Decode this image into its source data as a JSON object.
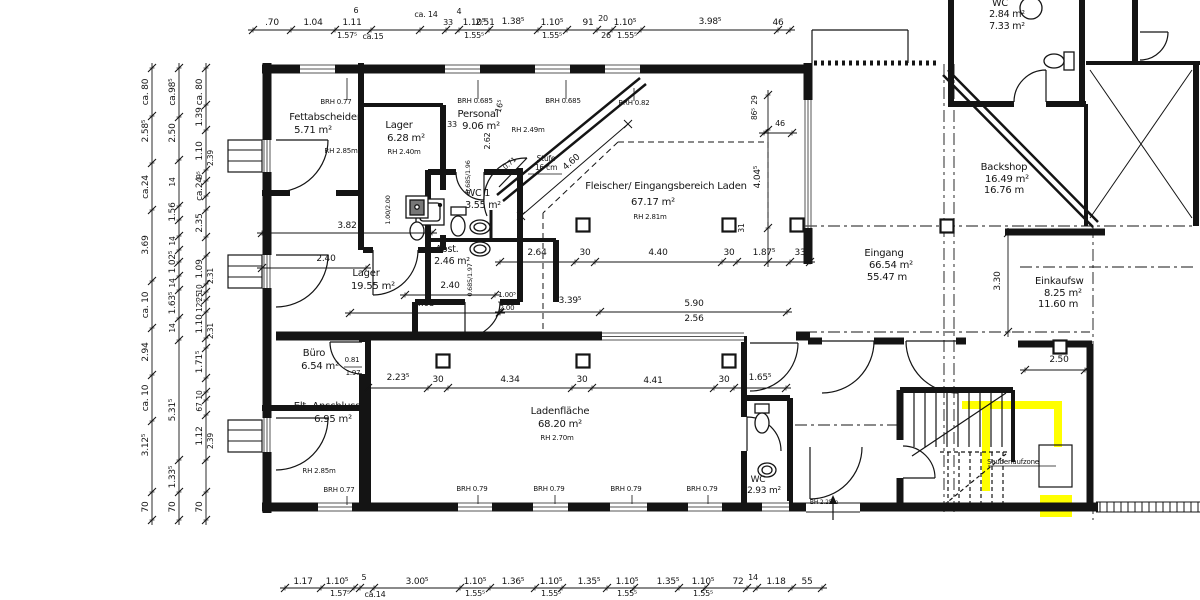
{
  "meta": {
    "drawing_type": "architectural floor plan",
    "highlight_color": "#ffff00",
    "line_color": "#141414",
    "background": "#ffffff"
  },
  "labels": [
    {
      "t": ".70",
      "x": 272,
      "y": 25
    },
    {
      "t": "1.04",
      "x": 313,
      "y": 25
    },
    {
      "t": "6",
      "x": 356,
      "y": 13,
      "s": 8
    },
    {
      "t": "1.11",
      "x": 352,
      "y": 25
    },
    {
      "t": "1.57⁵",
      "x": 347,
      "y": 38,
      "s": 8
    },
    {
      "t": "ca.15",
      "x": 373,
      "y": 39,
      "s": 8
    },
    {
      "t": "ca. 14",
      "x": 426,
      "y": 17,
      "s": 8
    },
    {
      "t": "2.51",
      "x": 485,
      "y": 25
    },
    {
      "t": "33",
      "x": 448,
      "y": 25,
      "s": 8
    },
    {
      "t": "4",
      "x": 459,
      "y": 14,
      "s": 8
    },
    {
      "t": "1.10⁵",
      "x": 474,
      "y": 25
    },
    {
      "t": "1.55⁵",
      "x": 474,
      "y": 38,
      "s": 8
    },
    {
      "t": "1.38⁵",
      "x": 513,
      "y": 24
    },
    {
      "t": "1.10⁵",
      "x": 552,
      "y": 25
    },
    {
      "t": "1.55⁵",
      "x": 552,
      "y": 38,
      "s": 8
    },
    {
      "t": "91",
      "x": 588,
      "y": 25
    },
    {
      "t": "20",
      "x": 603,
      "y": 21,
      "s": 8
    },
    {
      "t": "26",
      "x": 606,
      "y": 38,
      "s": 8
    },
    {
      "t": "1.10⁵",
      "x": 625,
      "y": 25
    },
    {
      "t": "1.55⁵",
      "x": 627,
      "y": 38,
      "s": 8
    },
    {
      "t": "3.98⁵",
      "x": 710,
      "y": 24
    },
    {
      "t": "46",
      "x": 778,
      "y": 25
    },
    {
      "t": "1.17",
      "x": 303,
      "y": 584
    },
    {
      "t": "1.10⁵",
      "x": 337,
      "y": 584
    },
    {
      "t": "1.57⁵",
      "x": 340,
      "y": 596,
      "s": 8
    },
    {
      "t": "5",
      "x": 364,
      "y": 580,
      "s": 8
    },
    {
      "t": "ca.14",
      "x": 375,
      "y": 597,
      "s": 8
    },
    {
      "t": "3.00⁵",
      "x": 417,
      "y": 584
    },
    {
      "t": "1.10⁵",
      "x": 475,
      "y": 584
    },
    {
      "t": "1.55⁵",
      "x": 475,
      "y": 596,
      "s": 8
    },
    {
      "t": "1.36⁵",
      "x": 513,
      "y": 584
    },
    {
      "t": "1.10⁵",
      "x": 551,
      "y": 584
    },
    {
      "t": "1.55⁵",
      "x": 551,
      "y": 596,
      "s": 8
    },
    {
      "t": "1.35⁵",
      "x": 589,
      "y": 584
    },
    {
      "t": "1.10⁵",
      "x": 627,
      "y": 584
    },
    {
      "t": "1.55⁵",
      "x": 627,
      "y": 596,
      "s": 8
    },
    {
      "t": "1.35⁵",
      "x": 668,
      "y": 584
    },
    {
      "t": "1.10⁵",
      "x": 703,
      "y": 584
    },
    {
      "t": "1.55⁵",
      "x": 703,
      "y": 596,
      "s": 8
    },
    {
      "t": "72",
      "x": 738,
      "y": 584
    },
    {
      "t": "14",
      "x": 753,
      "y": 580,
      "s": 8
    },
    {
      "t": "1.18",
      "x": 776,
      "y": 584
    },
    {
      "t": "55",
      "x": 807,
      "y": 584
    },
    {
      "t": "ca. 80",
      "x": 148,
      "y": 92,
      "r": -90
    },
    {
      "t": "2.58⁵",
      "x": 148,
      "y": 131,
      "r": -90
    },
    {
      "t": "ca.24",
      "x": 148,
      "y": 187,
      "r": -90
    },
    {
      "t": "3.69",
      "x": 148,
      "y": 245,
      "r": -90
    },
    {
      "t": "ca. 10",
      "x": 148,
      "y": 305,
      "r": -90
    },
    {
      "t": "2.94",
      "x": 148,
      "y": 352,
      "r": -90
    },
    {
      "t": "ca. 10",
      "x": 148,
      "y": 398,
      "r": -90
    },
    {
      "t": "3.12⁵",
      "x": 148,
      "y": 445,
      "r": -90
    },
    {
      "t": "70",
      "x": 148,
      "y": 507,
      "r": -90
    },
    {
      "t": "ca.98⁵",
      "x": 175,
      "y": 92,
      "r": -90
    },
    {
      "t": "2.50",
      "x": 175,
      "y": 133,
      "r": -90
    },
    {
      "t": "14",
      "x": 175,
      "y": 182,
      "r": -90,
      "s": 7.5
    },
    {
      "t": "1.56",
      "x": 175,
      "y": 212,
      "r": -90
    },
    {
      "t": "14",
      "x": 175,
      "y": 241,
      "r": -90,
      "s": 7.5
    },
    {
      "t": "1.02⁵",
      "x": 175,
      "y": 262,
      "r": -90
    },
    {
      "t": "14",
      "x": 175,
      "y": 283,
      "r": -90,
      "s": 7.5
    },
    {
      "t": "1.63⁵",
      "x": 175,
      "y": 303,
      "r": -90
    },
    {
      "t": "14",
      "x": 175,
      "y": 328,
      "r": -90,
      "s": 7.5
    },
    {
      "t": "5.31⁵",
      "x": 175,
      "y": 410,
      "r": -90
    },
    {
      "t": "1.33⁵",
      "x": 175,
      "y": 477,
      "r": -90
    },
    {
      "t": "70",
      "x": 175,
      "y": 507,
      "r": -90
    },
    {
      "t": "ca. 80",
      "x": 202,
      "y": 92,
      "r": -90
    },
    {
      "t": "1.39",
      "x": 202,
      "y": 117,
      "r": -90
    },
    {
      "t": "1.10",
      "x": 202,
      "y": 151,
      "r": -90
    },
    {
      "t": "9⁵",
      "x": 202,
      "y": 175,
      "r": -90,
      "s": 7.5
    },
    {
      "t": "ca.24",
      "x": 202,
      "y": 189,
      "r": -90
    },
    {
      "t": "2.35",
      "x": 202,
      "y": 223,
      "r": -90
    },
    {
      "t": "1.09",
      "x": 202,
      "y": 269,
      "r": -90
    },
    {
      "t": "10",
      "x": 202,
      "y": 289,
      "r": -90,
      "s": 7.5
    },
    {
      "t": "25",
      "x": 202,
      "y": 297,
      "r": -90,
      "s": 7.5
    },
    {
      "t": "12⁵",
      "x": 202,
      "y": 306,
      "r": -90,
      "s": 7.5
    },
    {
      "t": "1.10",
      "x": 202,
      "y": 324,
      "r": -90
    },
    {
      "t": "1.71⁵",
      "x": 202,
      "y": 362,
      "r": -90
    },
    {
      "t": "10",
      "x": 202,
      "y": 395,
      "r": -90,
      "s": 7.5
    },
    {
      "t": "67",
      "x": 202,
      "y": 407,
      "r": -90,
      "s": 7.5
    },
    {
      "t": "1.12",
      "x": 202,
      "y": 436,
      "r": -90
    },
    {
      "t": "70",
      "x": 202,
      "y": 507,
      "r": -90
    },
    {
      "t": "2.39",
      "x": 213,
      "y": 158,
      "r": -90,
      "s": 7.5
    },
    {
      "t": "2.31",
      "x": 213,
      "y": 276,
      "r": -90,
      "s": 7.5
    },
    {
      "t": "2.31",
      "x": 213,
      "y": 331,
      "r": -90,
      "s": 7.5
    },
    {
      "t": "2.39",
      "x": 213,
      "y": 441,
      "r": -90,
      "s": 7.5
    },
    {
      "t": "29",
      "x": 757,
      "y": 100,
      "r": -90,
      "s": 7.5
    },
    {
      "t": "86⁵",
      "x": 757,
      "y": 114,
      "r": -90,
      "s": 7.5
    },
    {
      "t": "4.04⁵",
      "x": 760,
      "y": 177,
      "r": -90
    },
    {
      "t": "31",
      "x": 744,
      "y": 228,
      "r": -90,
      "s": 7.5
    },
    {
      "t": "3.30",
      "x": 1000,
      "y": 281,
      "r": -90
    },
    {
      "t": "46",
      "x": 780,
      "y": 126,
      "s": 8
    },
    {
      "n": "room-fettabscheider",
      "t": "Fettabscheider",
      "x": 325,
      "y": 120,
      "s": 10
    },
    {
      "t": "5.71 m²",
      "x": 313,
      "y": 133,
      "s": 10
    },
    {
      "t": "BRH 0.77",
      "x": 336,
      "y": 104,
      "s": 7
    },
    {
      "t": "RH 2.85m",
      "x": 341,
      "y": 153,
      "s": 7
    },
    {
      "n": "room-lager-1",
      "t": "Lager",
      "x": 399,
      "y": 128,
      "s": 10
    },
    {
      "t": "6.28 m²",
      "x": 406,
      "y": 141,
      "s": 10
    },
    {
      "t": "RH 2.40m",
      "x": 404,
      "y": 154,
      "s": 7
    },
    {
      "n": "room-personal",
      "t": "Personal",
      "x": 478,
      "y": 117,
      "s": 10
    },
    {
      "t": "9.06 m²",
      "x": 481,
      "y": 129,
      "s": 10
    },
    {
      "t": "33",
      "x": 452,
      "y": 127,
      "s": 8
    },
    {
      "t": "BRH 0.685",
      "x": 475,
      "y": 103,
      "s": 7
    },
    {
      "t": "2.62",
      "x": 490,
      "y": 141,
      "r": -90,
      "s": 8
    },
    {
      "t": "16⁵",
      "x": 502,
      "y": 107,
      "r": -75,
      "s": 8
    },
    {
      "t": "BRH 0.685",
      "x": 563,
      "y": 103,
      "s": 7
    },
    {
      "t": "BRH 0.82",
      "x": 634,
      "y": 105,
      "s": 7
    },
    {
      "t": "RH 2.49m",
      "x": 528,
      "y": 132,
      "s": 7
    },
    {
      "t": "Stufe",
      "x": 546,
      "y": 161,
      "s": 7.5
    },
    {
      "t": "16 cm",
      "x": 546,
      "y": 170,
      "s": 7.5
    },
    {
      "t": "4.60",
      "x": 573,
      "y": 164,
      "r": -41
    },
    {
      "t": "0.71",
      "x": 511,
      "y": 165,
      "r": -41,
      "s": 7
    },
    {
      "n": "room-fleischer",
      "t": "Fleischer/ Eingangsbereich Laden",
      "x": 666,
      "y": 189,
      "s": 10
    },
    {
      "t": "67.17 m²",
      "x": 653,
      "y": 205,
      "s": 10
    },
    {
      "t": "RH 2.81m",
      "x": 650,
      "y": 219,
      "s": 7
    },
    {
      "n": "room-wc1",
      "t": "WC 1",
      "x": 478,
      "y": 196,
      "s": 9.5
    },
    {
      "t": "3.55 m²",
      "x": 483,
      "y": 208,
      "s": 9.5
    },
    {
      "t": "0.685/1.96",
      "x": 470,
      "y": 177,
      "r": -90,
      "s": 6.5
    },
    {
      "n": "room-abst",
      "t": "Abst.",
      "x": 447,
      "y": 252,
      "s": 9.5
    },
    {
      "t": "2.46 m²",
      "x": 452,
      "y": 264,
      "s": 9.5
    },
    {
      "t": "0.685/1.97",
      "x": 472,
      "y": 280,
      "r": -90,
      "s": 6.5
    },
    {
      "n": "room-lager-2",
      "t": "Lager",
      "x": 366,
      "y": 276,
      "s": 10
    },
    {
      "t": "19.55 m²",
      "x": 373,
      "y": 289,
      "s": 10
    },
    {
      "t": "1.00/2.00",
      "x": 390,
      "y": 210,
      "r": -90,
      "s": 6.5
    },
    {
      "t": "3.82",
      "x": 347,
      "y": 228
    },
    {
      "t": "2.40",
      "x": 326,
      "y": 261
    },
    {
      "t": "2.40",
      "x": 450,
      "y": 288
    },
    {
      "t": "4.05",
      "x": 425,
      "y": 306
    },
    {
      "t": "1.00⁵",
      "x": 507,
      "y": 297,
      "s": 7
    },
    {
      "t": "2.00",
      "x": 507,
      "y": 310,
      "s": 7
    },
    {
      "t": "3.39⁵",
      "x": 570,
      "y": 303
    },
    {
      "t": "5.90",
      "x": 694,
      "y": 306
    },
    {
      "t": "2.56",
      "x": 694,
      "y": 321
    },
    {
      "t": "2.64",
      "x": 537,
      "y": 255
    },
    {
      "t": "30",
      "x": 585,
      "y": 255
    },
    {
      "t": "4.40",
      "x": 658,
      "y": 255
    },
    {
      "t": "30",
      "x": 729,
      "y": 255
    },
    {
      "t": "1.87⁵",
      "x": 764,
      "y": 255
    },
    {
      "t": "33",
      "x": 800,
      "y": 255
    },
    {
      "n": "room-buero",
      "t": "Büro",
      "x": 314,
      "y": 356,
      "s": 10
    },
    {
      "t": "6.54 m²",
      "x": 320,
      "y": 369,
      "s": 10
    },
    {
      "t": "0.81",
      "x": 352,
      "y": 362,
      "s": 7
    },
    {
      "t": "1.97",
      "x": 353,
      "y": 375,
      "s": 7
    },
    {
      "t": "2.23⁵",
      "x": 398,
      "y": 380
    },
    {
      "t": "30",
      "x": 438,
      "y": 382
    },
    {
      "t": "4.34",
      "x": 510,
      "y": 382
    },
    {
      "t": "30",
      "x": 582,
      "y": 382
    },
    {
      "t": "4.41",
      "x": 653,
      "y": 383
    },
    {
      "t": "30",
      "x": 724,
      "y": 382
    },
    {
      "t": "1.65⁵",
      "x": 760,
      "y": 380
    },
    {
      "n": "room-elt",
      "t": "Elt.-Anschluss",
      "x": 327,
      "y": 409,
      "s": 10
    },
    {
      "t": "6.95 m²",
      "x": 333,
      "y": 422,
      "s": 10
    },
    {
      "t": "RH 2.85m",
      "x": 319,
      "y": 473,
      "s": 7
    },
    {
      "t": "BRH 0.77",
      "x": 339,
      "y": 492,
      "s": 7
    },
    {
      "n": "room-ladenflaeche",
      "t": "Ladenfläche",
      "x": 560,
      "y": 414,
      "s": 10
    },
    {
      "t": "68.20 m²",
      "x": 560,
      "y": 427,
      "s": 10
    },
    {
      "t": "RH 2.70m",
      "x": 557,
      "y": 440,
      "s": 7
    },
    {
      "t": "BRH 0.79",
      "x": 472,
      "y": 491,
      "s": 7
    },
    {
      "t": "BRH 0.79",
      "x": 549,
      "y": 491,
      "s": 7
    },
    {
      "t": "BRH 0.79",
      "x": 626,
      "y": 491,
      "s": 7
    },
    {
      "t": "BRH 0.79",
      "x": 702,
      "y": 491,
      "s": 7
    },
    {
      "n": "room-wc-klein",
      "t": "WC",
      "x": 758,
      "y": 482,
      "s": 9
    },
    {
      "t": "2.93 m²",
      "x": 764,
      "y": 493,
      "s": 9
    },
    {
      "t": "BH 2.25m",
      "x": 824,
      "y": 504,
      "s": 6
    },
    {
      "n": "room-eingang",
      "t": "Eingang",
      "x": 884,
      "y": 256,
      "s": 10
    },
    {
      "t": "66.54 m²",
      "x": 891,
      "y": 268,
      "s": 10
    },
    {
      "t": "55.47 m",
      "x": 887,
      "y": 280,
      "s": 10
    },
    {
      "n": "room-backshop",
      "t": "Backshop",
      "x": 1004,
      "y": 170,
      "s": 10
    },
    {
      "t": "16.49 m²",
      "x": 1007,
      "y": 182,
      "s": 10
    },
    {
      "t": "16.76 m",
      "x": 1004,
      "y": 193,
      "s": 10
    },
    {
      "n": "room-einkaufswagen",
      "t": "Einkaufsw",
      "x": 1035,
      "y": 284,
      "s": 10,
      "a": "start"
    },
    {
      "t": "8.25 m²",
      "x": 1044,
      "y": 296,
      "s": 10,
      "a": "start"
    },
    {
      "t": "11.60 m",
      "x": 1038,
      "y": 307,
      "s": 10,
      "a": "start"
    },
    {
      "t": "2.50",
      "x": 1059,
      "y": 362
    },
    {
      "n": "label-sauberlaufzone",
      "t": "Sauberlaufzone",
      "x": 1013,
      "y": 464,
      "s": 7
    },
    {
      "n": "room-wc-top",
      "t": "WC",
      "x": 1000,
      "y": 6,
      "s": 9.5
    },
    {
      "t": "2.84 m²",
      "x": 1007,
      "y": 17,
      "s": 9.5
    },
    {
      "t": "7.33 m²",
      "x": 1007,
      "y": 29,
      "s": 9.5
    }
  ]
}
